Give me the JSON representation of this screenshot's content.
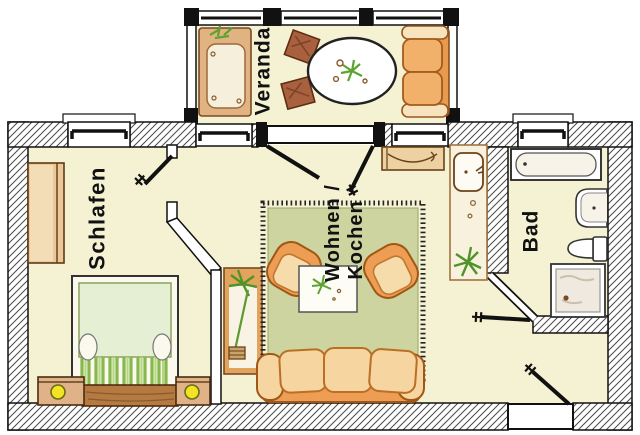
{
  "floorplan": {
    "rooms": {
      "veranda": {
        "label": "Veranda"
      },
      "schlafen": {
        "label": "Schlafen"
      },
      "wohnen_kochen": {
        "label_line1": "Wohnen /",
        "label_line2": "Kochen"
      },
      "bad": {
        "label": "Bad"
      }
    },
    "colors": {
      "floor": "#f5f2d3",
      "wall_fill": "#ffffff",
      "wall_hatch_line": "#4a4a4a",
      "outline": "#111111",
      "rug_green": "#cdd49f",
      "sofa_orange": "#ee9e54",
      "cushion_cream": "#f7dcab",
      "wood_light": "#ecc79a",
      "wood_dark": "#b57a40",
      "chair_brown": "#a9603f",
      "bed_green": "#e4efd3",
      "plant_green": "#5da32f",
      "lamp_yellow": "#f2e324"
    },
    "furniture": {
      "veranda": [
        "lounger",
        "potted-plant",
        "chair",
        "chair",
        "oval-table",
        "two-seat-sofa"
      ],
      "schlafen": [
        "wardrobe",
        "double-bed",
        "nightstand-with-lamp",
        "nightstand-with-lamp"
      ],
      "wohnen_kochen": [
        "kitchen-counter",
        "sink-counter",
        "tall-plant",
        "rug",
        "armchair",
        "armchair",
        "coffee-table",
        "three-seat-sofa"
      ],
      "bad": [
        "bathtub",
        "washbasin",
        "toilet",
        "shower"
      ]
    }
  }
}
